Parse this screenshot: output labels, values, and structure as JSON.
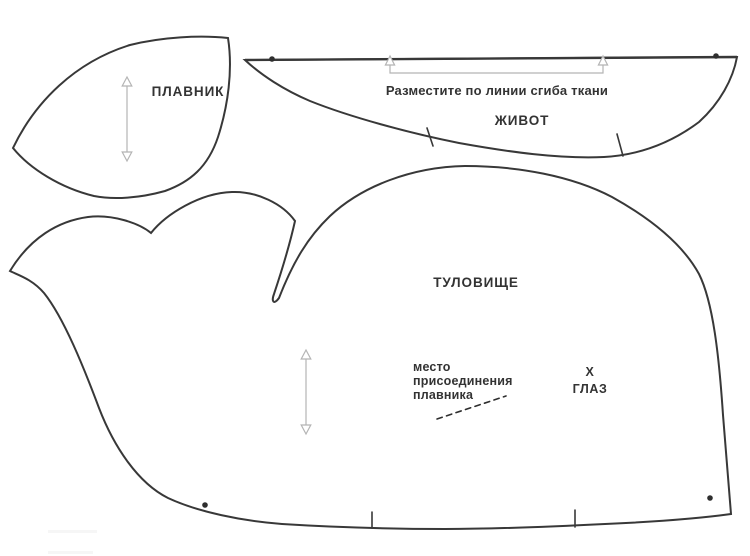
{
  "canvas": {
    "width": "750",
    "height": "556",
    "background": "#ffffff",
    "outline_color": "#383838",
    "text_color": "#333333",
    "guide_color": "#b4b4b4",
    "mark_color": "#2e2e2e"
  },
  "pieces": {
    "fin": {
      "label": "ПЛАВНИК"
    },
    "belly": {
      "label": "ЖИВОТ",
      "fold_instruction": "Разместите по линии сгиба ткани"
    },
    "body": {
      "label": "ТУЛОВИЩЕ",
      "fin_attachment_lines": [
        "место",
        "присоединения",
        "плавника"
      ],
      "eye_mark": "Х",
      "eye_label": "ГЛАЗ"
    }
  }
}
